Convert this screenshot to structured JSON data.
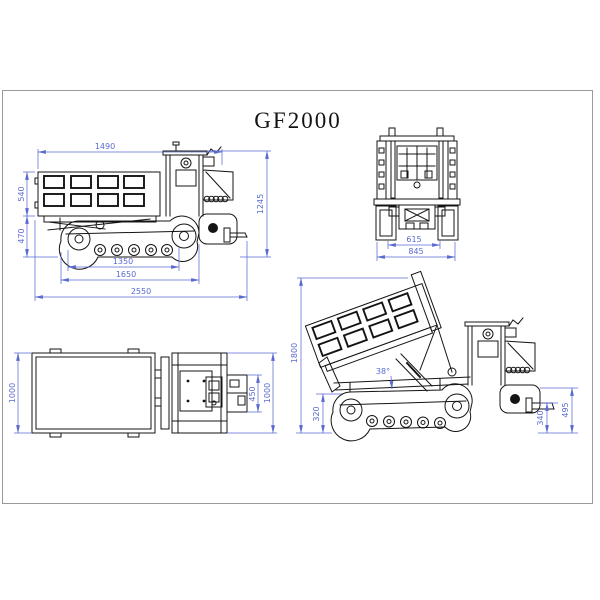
{
  "title": "GF2000",
  "colors": {
    "dim": "#5a6ad0",
    "ink": "#141414",
    "frame": "#9a9a9a",
    "bg": "#ffffff"
  },
  "views": {
    "side": {
      "dims": {
        "bed_length_top": "1490",
        "bed_side_height": "540",
        "chassis_height": "470",
        "overall_height": "1245",
        "wheelbase": "1350",
        "track_length": "1650",
        "overall_length": "2550"
      }
    },
    "rear": {
      "dims": {
        "track_inner_width": "615",
        "overall_width": "845"
      }
    },
    "plan": {
      "dims": {
        "bed_width": "1000",
        "chassis_inner_width": "450",
        "rear_width": "1000"
      }
    },
    "tipped": {
      "dims": {
        "dump_height": "1800",
        "tail_clearance": "320",
        "dump_angle": "38°",
        "fork_height": "340",
        "rear_height": "495"
      }
    }
  }
}
